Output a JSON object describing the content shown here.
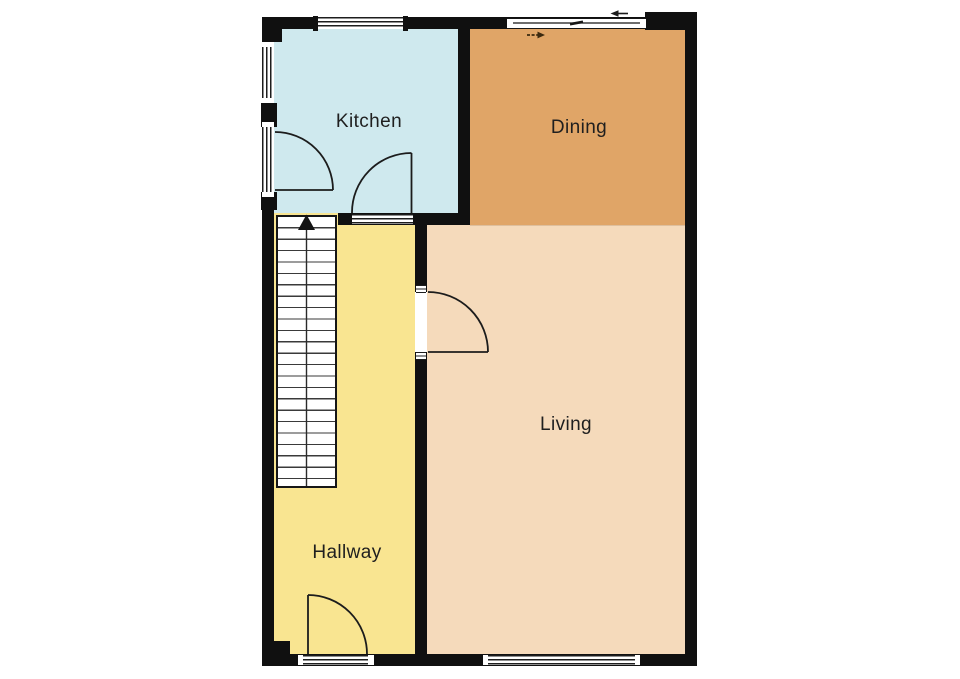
{
  "plan": {
    "rooms": {
      "kitchen": {
        "label": "Kitchen",
        "color": "#cfe9ee"
      },
      "dining": {
        "label": "Dining",
        "color": "#e0a567"
      },
      "living": {
        "label": "Living",
        "color": "#f5dabb"
      },
      "hallway": {
        "label": "Hallway",
        "color": "#f9e591"
      }
    },
    "stairs": {
      "steps": 23,
      "direction": "up",
      "icon": "stairs-up-arrow-icon"
    },
    "doors": {
      "kitchen_side_door": "swings into kitchen from left wall",
      "kitchen_hall_door": "swings into kitchen from hallway",
      "living_door": "swings into living from hallway",
      "entrance_door": "swings into hallway from bottom wall"
    },
    "icons": {
      "slide_direction_outside": "arrow-left-icon",
      "slide_direction_inside": "arrow-right-icon"
    },
    "colors": {
      "wall": "#101010",
      "door_line": "#1c1c1c",
      "background": "#ffffff"
    }
  }
}
